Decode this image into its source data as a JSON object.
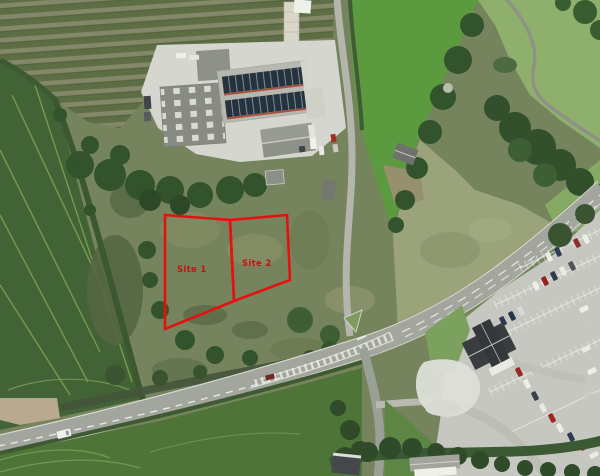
{
  "meta": {
    "description": "Aerial photograph of farmland beside a road junction, with two development site boundaries outlined in red",
    "image_width_px": 600,
    "image_height_px": 476
  },
  "overlays": {
    "outline_color": "#e8100e",
    "label_color": "#c21313",
    "sites": [
      {
        "label": "Site 1",
        "points": "165,215 230,220 234,301 165,329"
      },
      {
        "label": "Site 2",
        "points": "230,220 287,215 290,280 234,301"
      }
    ]
  },
  "features": {
    "orchard": "rows of fruit trees, top left",
    "warehouse": "large grey industrial building with windowed wall",
    "solar_roof": "roof with two bands of dark solar panels",
    "barn": "grey gable-roof farm building",
    "greenhouse": "long narrow pale structure at top of orchard",
    "access_lane": "narrow lane running from farmyard down to the main road",
    "main_road": "main road crossing diagonally with white centre hatching",
    "side_road": "minor road heading south from the junction",
    "junction_island": "small grass triangle at road junction",
    "car_park": "car park with marked bays and many parked cars, bottom right",
    "pub_building": "dark hipped-roof building beside the car park",
    "gravel_area": "pale gravel patch west of the car park",
    "parkland": "lawn with winding path and mature trees, top right",
    "fields": "green arable fields with tramlines",
    "white_house": "white building at bottom centre"
  },
  "palette": {
    "field_dark_green": "#426335",
    "field_bright_green": "#5c9a3f",
    "scrub_olive": "#75845c",
    "parkland_green": "#8fb06c",
    "tree_dark_green": "#33532c",
    "concrete": "#d5d6cf",
    "road_asphalt": "#a3a69e",
    "road_marking_white": "#eef0e8",
    "building_grey": "#888b83",
    "solar_panel_navy": "#26333f",
    "car_park_tarmac": "#c5c7c0",
    "pub_roof_dark": "#3a3d3f",
    "gravel_white": "#dddfd8",
    "overlay_red": "#e8100e"
  }
}
